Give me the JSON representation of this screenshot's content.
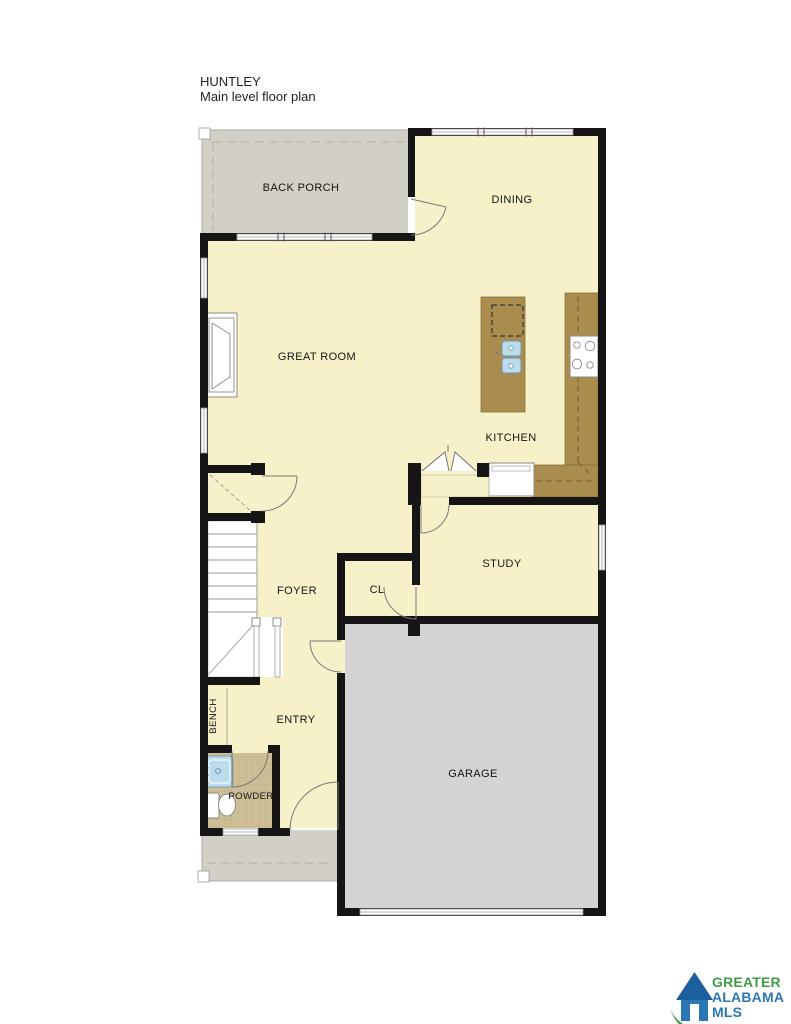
{
  "title": {
    "line1": "HUNTLEY",
    "line2": "Main level floor plan"
  },
  "rooms": {
    "back_porch": "BACK PORCH",
    "dining": "DINING",
    "great_room": "GREAT ROOM",
    "kitchen": "KITCHEN",
    "study": "STUDY",
    "foyer": "FOYER",
    "closet": "CL",
    "entry": "ENTRY",
    "bench": "BENCH",
    "powder": "POWDER",
    "garage": "GARAGE"
  },
  "logo": {
    "line1": "GREATER",
    "line2": "ALABAMA",
    "line3": "MLS"
  },
  "colors": {
    "floor": "#f6f1c9",
    "porch": "#d2cfc6",
    "garage": "#d4d4d4",
    "counter": "#a98c4e",
    "counter_dark": "#86713c",
    "wall": "#151515",
    "tile": "#cdbe96",
    "tile_line": "#bcae86",
    "sink": "#bcdcee",
    "fixture_line": "#8a8a8a",
    "window_line": "#9a9a9a",
    "dash": "#b9ad9a",
    "label": "#141414",
    "logo_green": "#3f9b45",
    "logo_blue": "#2b76b4",
    "logo_roof": "#1d5f9c"
  }
}
